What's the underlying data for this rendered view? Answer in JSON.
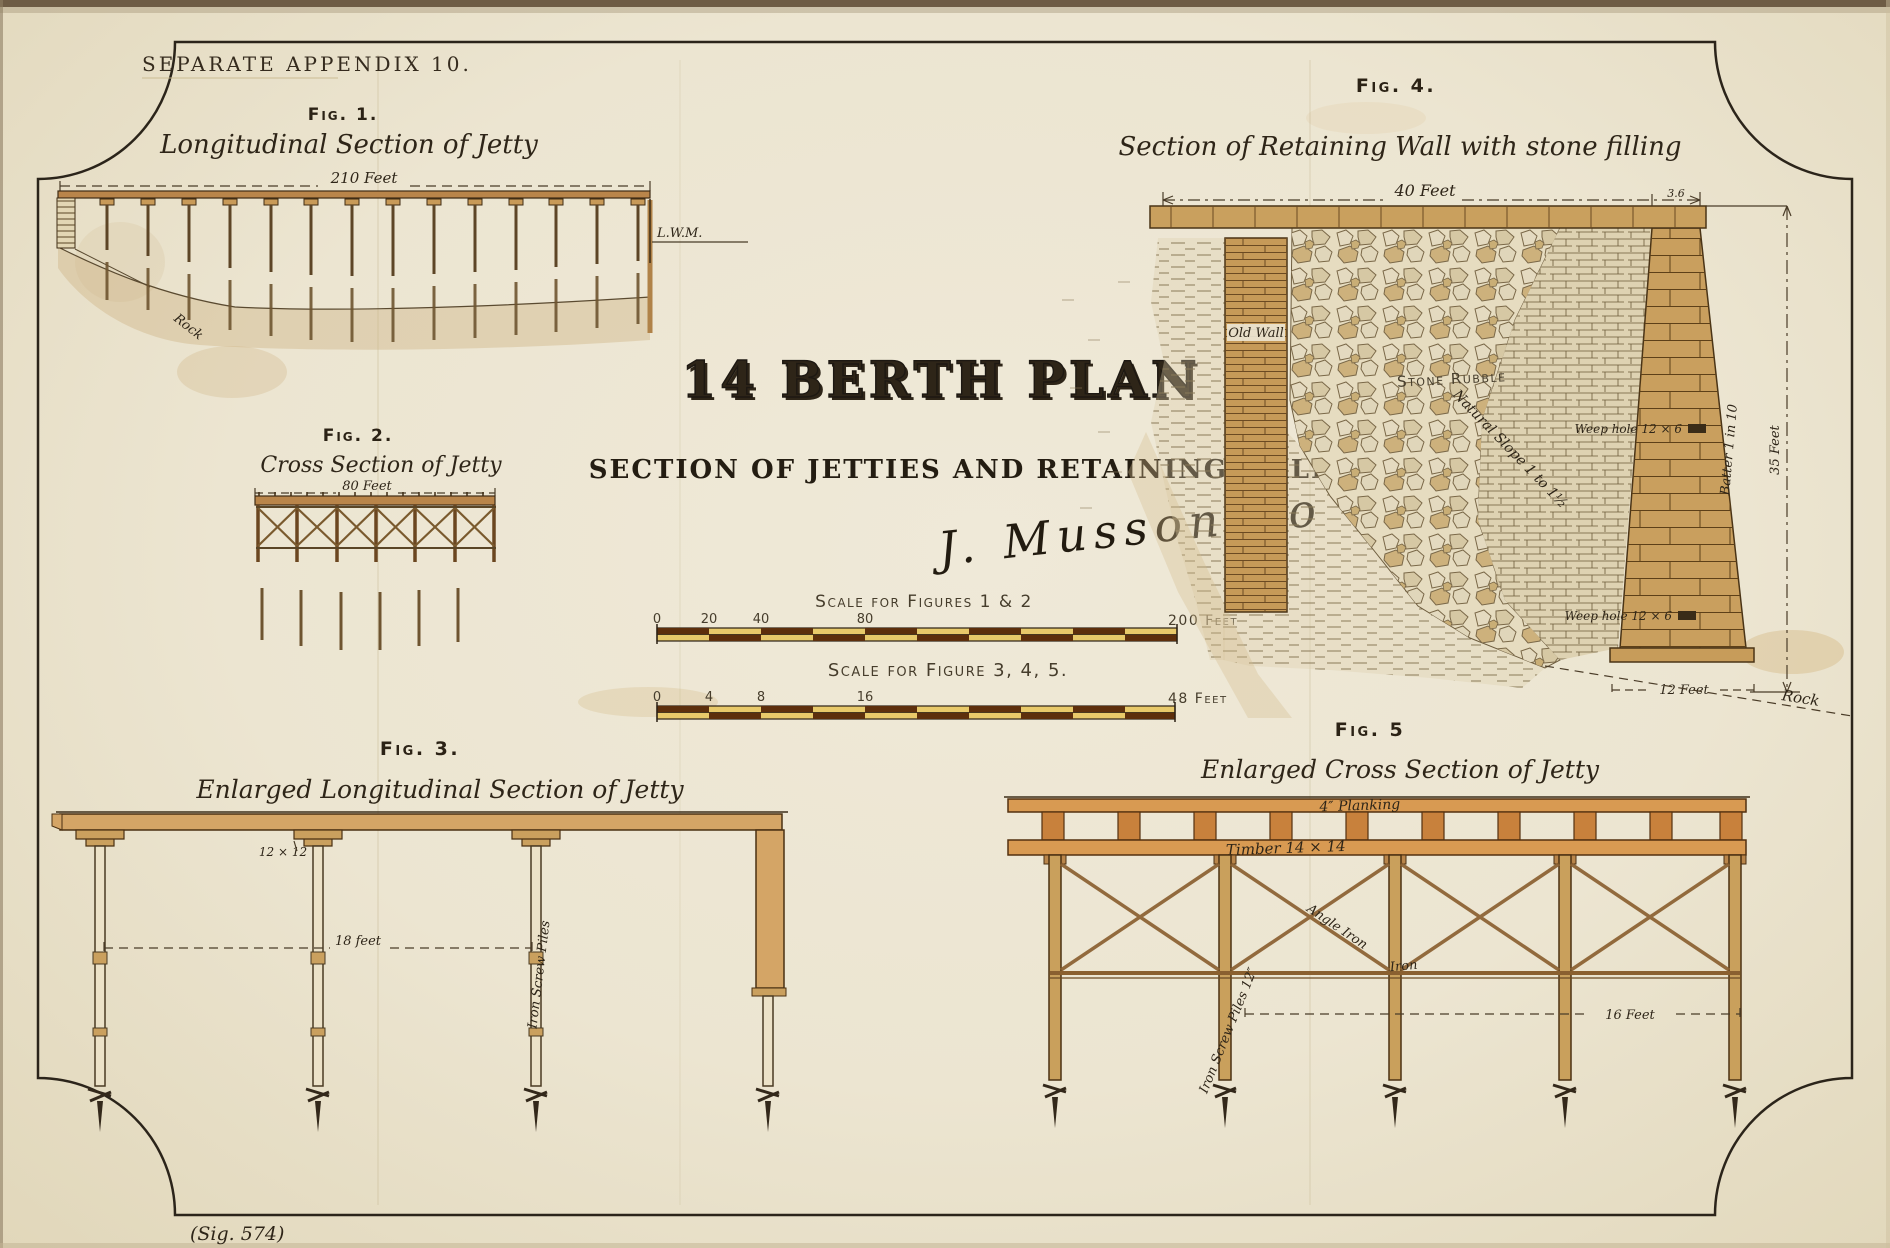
{
  "page": {
    "appendix": "SEPARATE APPENDIX 10.",
    "sig_note": "(Sig. 574)"
  },
  "title": {
    "main": "14 BERTH PLAN",
    "subtitle": "SECTION OF JETTIES AND RETAINING WALL",
    "signature": "J. Musson Ro"
  },
  "figures": {
    "fig1": {
      "label": "Fig. 1.",
      "title": "Longitudinal Section of Jetty",
      "dim": "210 Feet",
      "lwm": "L.W.M.",
      "rock": "Rock"
    },
    "fig2": {
      "label": "Fig. 2.",
      "title": "Cross Section of Jetty",
      "dim": "80 Feet"
    },
    "fig3": {
      "label": "Fig. 3.",
      "title": "Enlarged Longitudinal Section of Jetty",
      "cap_size": "12 × 12",
      "span": "18 feet",
      "pile_note": "Iron Screw Piles"
    },
    "fig4": {
      "label": "Fig. 4.",
      "title": "Section of Retaining Wall with stone filling",
      "dim_top": "40 Feet",
      "dim_coping": "3.6",
      "old_wall": "Old Wall",
      "stone_rubble": "Stone Rubble",
      "natural_slope": "Natural Slope 1 to 1½",
      "weep_upper": "Weep hole 12 × 6",
      "weep_lower": "Weep hole 12 × 6",
      "batter": "Batter 1 in 10",
      "wall_height": "35 Feet",
      "base_width": "12 Feet",
      "rock": "Rock"
    },
    "fig5": {
      "label": "Fig. 5",
      "title": "Enlarged Cross Section of Jetty",
      "planking": "4″ Planking",
      "timber": "Timber 14 × 14",
      "angle_iron": "Angle Iron",
      "iron": "Iron",
      "span": "16 Feet",
      "pile_note": "Iron Screw Piles 12″"
    }
  },
  "scales": {
    "fig12": {
      "label": "Scale for Figures 1 & 2",
      "ticks": [
        "0",
        "20",
        "40",
        "80"
      ],
      "end": "200 Feet"
    },
    "fig345": {
      "label": "Scale for Figure 3, 4, 5.",
      "ticks": [
        "0",
        "4",
        "8",
        "16"
      ],
      "end": "48 Feet"
    }
  },
  "colors": {
    "paper": "#ece5d2",
    "ink": "#2e2518",
    "timber": "#c89a58",
    "timber_light": "#d4a566",
    "scale_dark": "#5d2f0c",
    "scale_gold": "#e8c96a",
    "title_fill": "#d9e2df"
  }
}
